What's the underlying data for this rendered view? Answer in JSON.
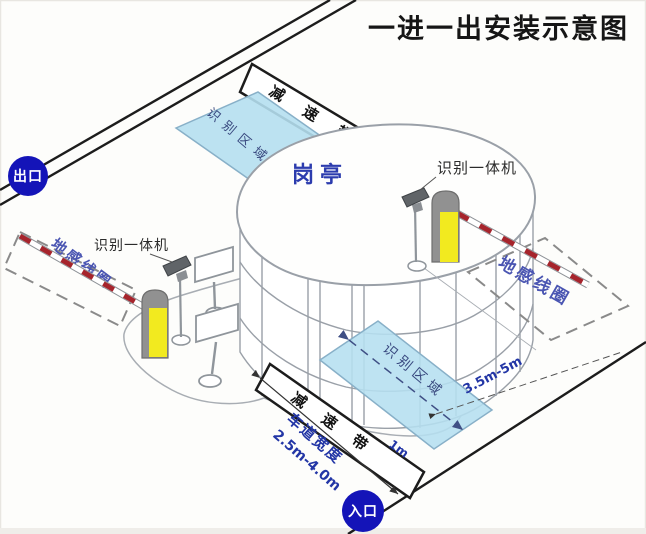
{
  "title": "一进一出安装示意图",
  "badges": {
    "exit": "出口",
    "entrance": "入口"
  },
  "booth": {
    "label": "岗亭"
  },
  "zones": {
    "recognition_top": "识别区域",
    "recognition_bottom": "识别区域"
  },
  "loops": {
    "left": "地感线圈",
    "right": "地感线圈"
  },
  "speed_bumps": {
    "top": "减速带",
    "bottom": "减速带"
  },
  "devices": {
    "left_reader": "识别一体机",
    "right_reader": "识别一体机"
  },
  "dimensions": {
    "lane_width_label": "车道宽度",
    "lane_width_value": "2.5m-4.0m",
    "loop_distance": "3.5m-5m",
    "offset": "1m"
  },
  "colors": {
    "badge_blue": "#1414b8",
    "area_blue": "#b5dff0",
    "accent_blue": "#2336a6",
    "loop_text_blue": "#4a55b2",
    "barrier_red": "#a6242c",
    "post_yellow": "#f2ea1f",
    "line_black": "#1c1c1c",
    "outline_gray": "#9aa0a8"
  }
}
